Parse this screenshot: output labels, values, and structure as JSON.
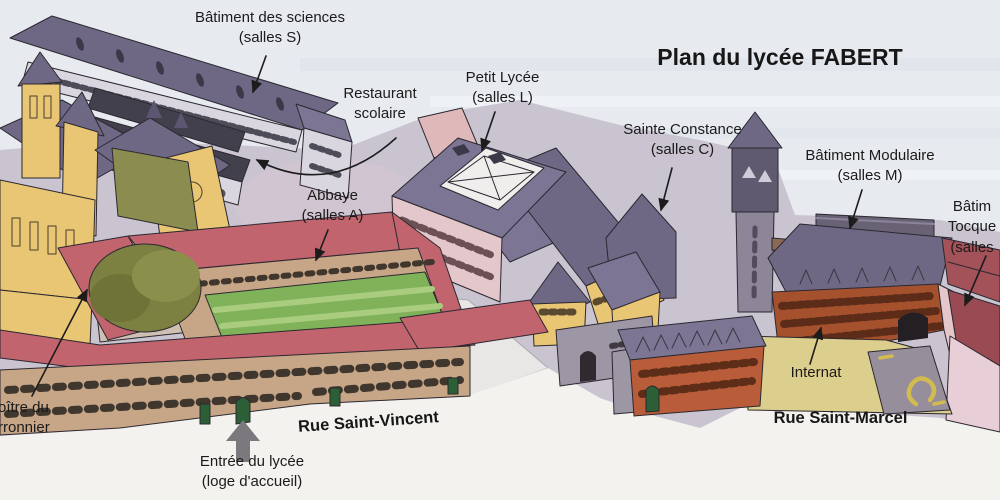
{
  "title": "Plan du lycée FABERT",
  "labels": {
    "sciences": {
      "line1": "Bâtiment des sciences",
      "line2": "(salles S)"
    },
    "restaurant": {
      "line1": "Restaurant",
      "line2": "scolaire"
    },
    "petit_lycee": {
      "line1": "Petit Lycée",
      "line2": "(salles L)"
    },
    "abbaye": {
      "line1": "Abbaye",
      "line2": "(salles A)"
    },
    "sainte_constance": {
      "line1": "Sainte Constance",
      "line2": "(salles C)"
    },
    "batiment_modulaire": {
      "line1": "Bâtiment Modulaire",
      "line2": "(salles M)"
    },
    "batiment_tocqueville": {
      "line1": "Bâtim",
      "line2": "Tocque",
      "line3": "(salles"
    },
    "cloitre_du_marronnier": {
      "line1": "oître du",
      "line2": "rronnier"
    },
    "internat": {
      "text": "Internat"
    },
    "entree": {
      "line1": "Entrée du lycée",
      "line2": "(loge d'accueil)"
    }
  },
  "streets": {
    "rue_saint_vincent": "Rue Saint-Vincent",
    "rue_saint_marcel": "Rue Saint-Marcel"
  },
  "colors": {
    "sky": "#e7ebef",
    "ground": "#cac3d0",
    "street": "#f3f2ef",
    "roof_purple": "#6f6885",
    "roof_purple_light": "#7d7594",
    "roof_red": "#c2646e",
    "wall_yellow": "#e9c673",
    "wall_tan": "#c7a687",
    "wall_pink": "#e4c7ca",
    "wall_light": "#d9d6e0",
    "wall_gray": "#9d96a4",
    "brick_orange": "#b95c3a",
    "brick_red": "#a5512e",
    "modulaire_gray": "#696275",
    "tocqueville_red": "#a4525a",
    "lawn_green": "#7fb259",
    "tree_olive": "#7c8040",
    "yard_yellow": "#dccf8d",
    "door_green": "#2d5f37",
    "label_text": "#1c1a1a"
  }
}
